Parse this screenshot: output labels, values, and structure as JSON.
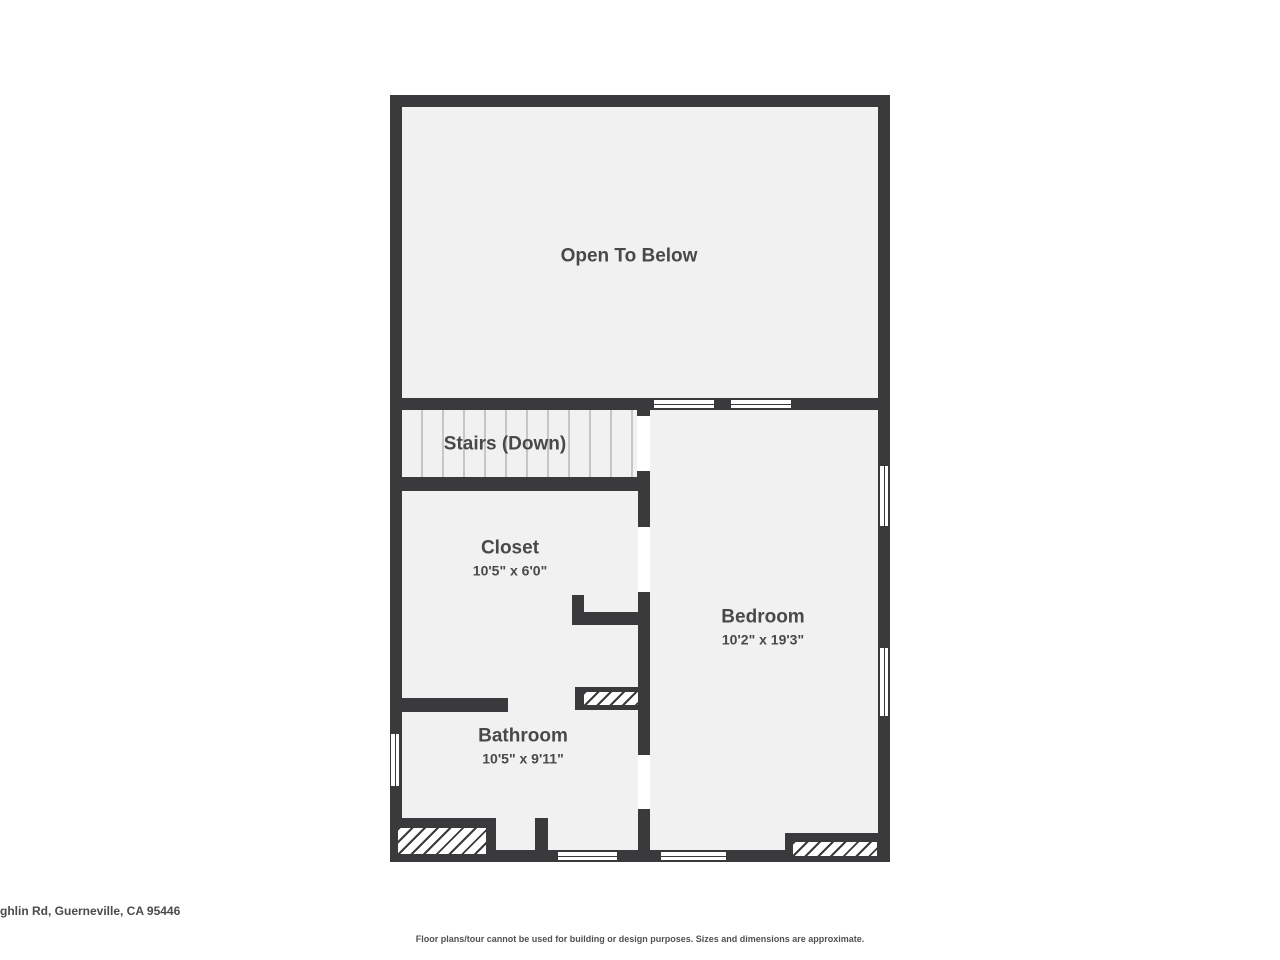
{
  "plan": {
    "colors": {
      "wall": "#3a3a3c",
      "floor": "#f1f1f2",
      "door_opening": "#ffffff",
      "label_text": "#49494b",
      "stair_tread_line": "#c6c6c6"
    },
    "rooms": {
      "open_to_below": {
        "label": "Open To Below"
      },
      "stairs": {
        "label": "Stairs (Down)"
      },
      "closet": {
        "label": "Closet",
        "dimensions": "10'5\" x 6'0\""
      },
      "bedroom": {
        "label": "Bedroom",
        "dimensions": "10'2\" x 19'3\""
      },
      "bathroom": {
        "label": "Bathroom",
        "dimensions": "10'5\" x 9'11\""
      }
    }
  },
  "footer": {
    "address": "ghlin Rd, Guerneville, CA 95446",
    "disclaimer": "Floor plans/tour cannot be used for building or design purposes. Sizes and dimensions are approximate."
  }
}
